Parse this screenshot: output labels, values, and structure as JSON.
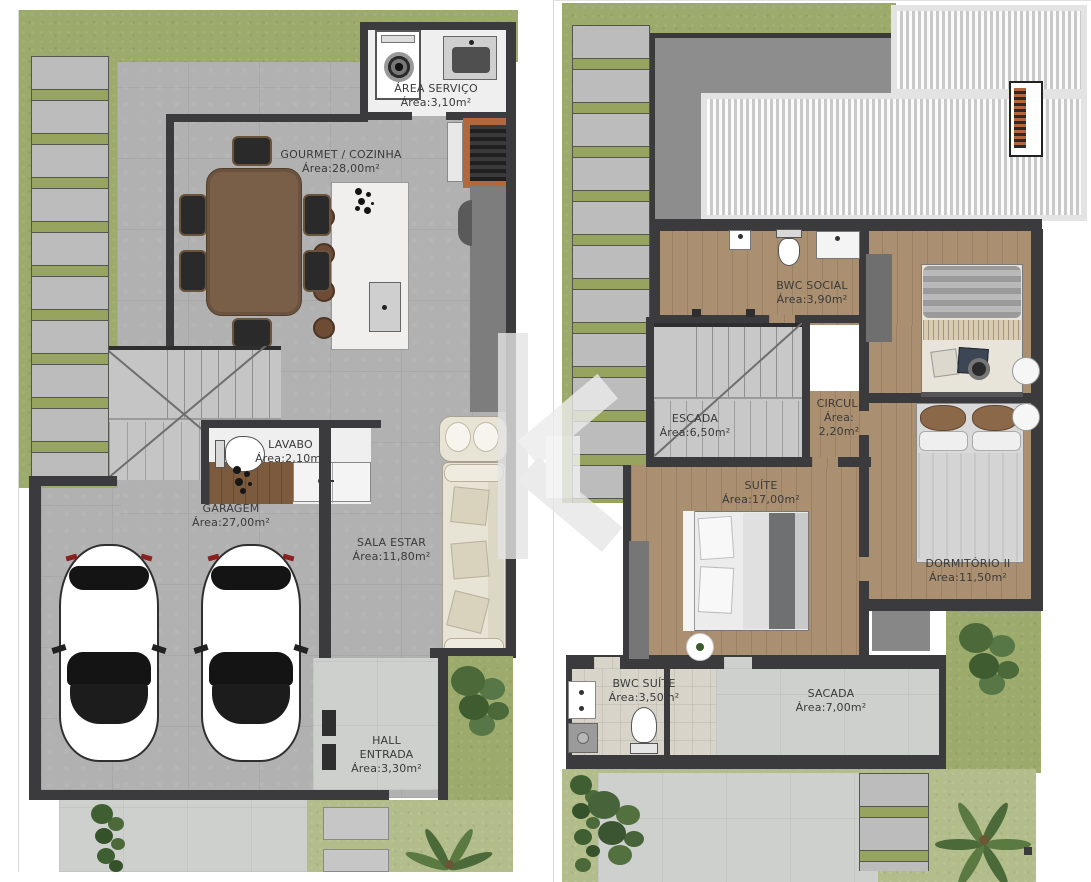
{
  "floor1": {
    "rooms": {
      "area_servico": {
        "name": "ÁREA SERVIÇO",
        "area": "Área:3,10m²"
      },
      "gourmet_cozinha": {
        "name": "GOURMET / COZINHA",
        "area": "Área:28,00m²"
      },
      "lavabo": {
        "name": "LAVABO",
        "area": "Área:2,10m²"
      },
      "garagem": {
        "name": "GARAGEM",
        "area": "Área:27,00m²"
      },
      "sala_estar": {
        "name": "SALA ESTAR",
        "area": "Área:11,80m²"
      },
      "hall_entrada": {
        "name": "HALL\nENTRADA",
        "area": "Área:3,30m²"
      }
    }
  },
  "floor2": {
    "rooms": {
      "bwc_social": {
        "name": "BWC SOCIAL",
        "area": "Área:3,90m²"
      },
      "escada": {
        "name": "ESCADA",
        "area": "Área:6,50m²"
      },
      "circul": {
        "name": "CIRCUL.",
        "area": "Área:\n2,20m²"
      },
      "suite": {
        "name": "SUÍTE",
        "area": "Área:17,00m²"
      },
      "dormitorio_ii": {
        "name": "DORMITÓRIO II",
        "area": "Área:11,50m²"
      },
      "bwc_suite": {
        "name": "BWC SUÍTE",
        "area": "Área:3,50m²"
      },
      "sacada": {
        "name": "SACADA",
        "area": "Área:7,00m²"
      }
    }
  },
  "colors": {
    "grass": "#9cab6c",
    "grass_light": "#b2bd8b",
    "paver": "#bcbcbc",
    "concrete": "#b1b1b1",
    "concrete_light": "#cdd0cd",
    "wall": "#3b3b3d",
    "wood_floor": "#aa9070",
    "wood_dark": "#7b5a3d",
    "bath_tile": "#d8d4c9",
    "slab": "#8d8d8d",
    "brick": "#b2673d",
    "table_wood": "#7a5f48",
    "sofa": "#e8e4d5",
    "label_text": "#3a3a3a"
  }
}
